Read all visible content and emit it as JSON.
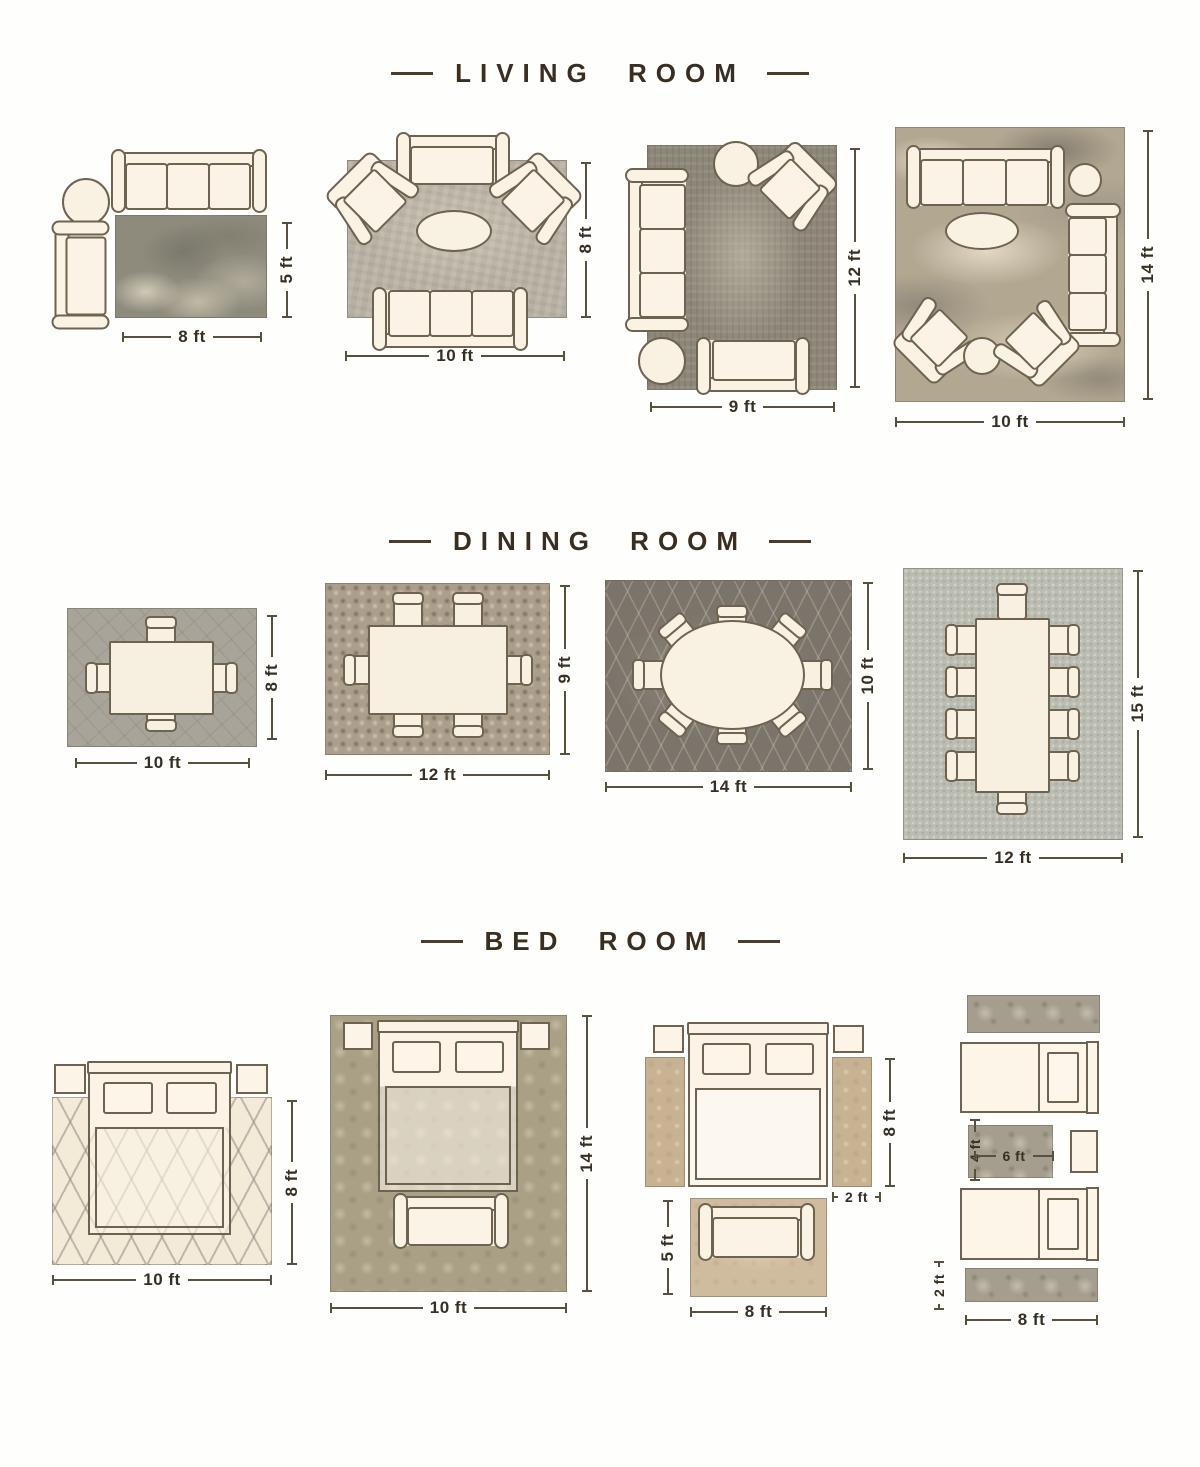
{
  "colors": {
    "accent_text": "#3a2e21",
    "furniture_outline": "#6e6250",
    "furniture_fill": "#faf2e4",
    "dimension_line": "#57503f"
  },
  "sections": [
    {
      "id": "living-room",
      "title": "LIVING ROOM",
      "layouts": [
        {
          "width_label": "8 ft",
          "height_label": "5 ft"
        },
        {
          "width_label": "10 ft",
          "height_label": "8 ft"
        },
        {
          "width_label": "9 ft",
          "height_label": "12 ft"
        },
        {
          "width_label": "10 ft",
          "height_label": "14 ft"
        }
      ]
    },
    {
      "id": "dining-room",
      "title": "DINING ROOM",
      "layouts": [
        {
          "width_label": "10 ft",
          "height_label": "8 ft"
        },
        {
          "width_label": "12 ft",
          "height_label": "9 ft"
        },
        {
          "width_label": "14 ft",
          "height_label": "10 ft"
        },
        {
          "width_label": "12 ft",
          "height_label": "15 ft"
        }
      ]
    },
    {
      "id": "bed-room",
      "title": "BED ROOM",
      "layouts": [
        {
          "width_label": "10 ft",
          "height_label": "8 ft"
        },
        {
          "width_label": "10 ft",
          "height_label": "14 ft"
        },
        {
          "runner_length_label": "8 ft",
          "runner_width_label": "2 ft",
          "accent_rug_height_label": "5 ft",
          "accent_rug_width_label": "8 ft"
        },
        {
          "center_rug_height_label": "4 ft",
          "center_rug_width_label": "6 ft",
          "runner_height_label": "2 ft",
          "runner_width_label": "8 ft"
        }
      ]
    }
  ]
}
